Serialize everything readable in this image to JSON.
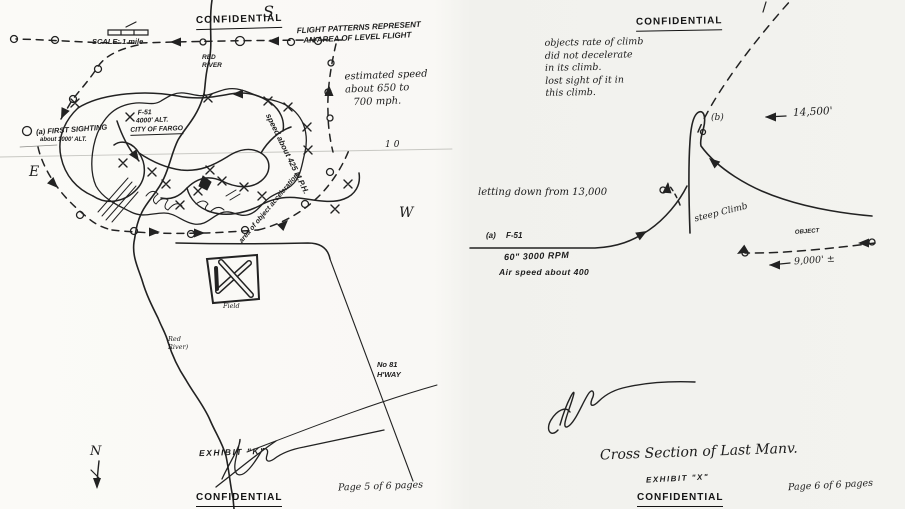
{
  "document": {
    "ink_color": "#1f1f1f",
    "paper_color": "#f7f6f3"
  },
  "left_page": {
    "stamp_top": "CONFIDENTIAL",
    "stamp_bottom": "CONFIDENTIAL",
    "compass": {
      "south": "S",
      "east": "E",
      "west": "W",
      "north": "N"
    },
    "scale_label": "SCALE: 1 mile",
    "flight_note": [
      "FLIGHT PATTERNS REPRESENT",
      "AN AREA OF LEVEL FLIGHT"
    ],
    "red_river_top": [
      "RED",
      "RIVER"
    ],
    "estimated_speed": [
      "estimated speed",
      "about 650 to",
      "700 mph."
    ],
    "first_sighting": [
      "(a) FIRST SIGHTING",
      "about 1000' ALT."
    ],
    "f51_position": [
      "F-51",
      "4000' ALT.",
      "CITY OF FARGO"
    ],
    "speed_arc": "speed about 425 M.P.H.",
    "acceleration_note": "area of object acceleration",
    "crease_number": "10",
    "field_label": "Field",
    "red_river_bottom": [
      "Red",
      "River)"
    ],
    "highway_label": [
      "No 81",
      "H'WAY"
    ],
    "exhibit": "EXHIBIT \"K\"",
    "page_note": "Page 5 of 6 pages"
  },
  "right_page": {
    "stamp_top": "CONFIDENTIAL",
    "stamp_bottom": "CONFIDENTIAL",
    "climb_note": [
      "objects rate of climb",
      "did not decelerate",
      "in its climb.",
      "lost sight of it in",
      "this climb."
    ],
    "point_b": "(b)",
    "peak_altitude": "14,500'",
    "letting_down": "letting down from 13,000",
    "steep_climb": "steep Climb",
    "point_a": "(a)  F-51",
    "engine_note": "60\" 3000 RPM",
    "airspeed_note": "Air speed about 400",
    "object_label": "OBJECT",
    "low_altitude": "9,000' ±",
    "caption": "Cross Section of Last Manv.",
    "exhibit": "EXHIBIT \"X\"",
    "page_note": "Page 6 of 6 pages"
  }
}
